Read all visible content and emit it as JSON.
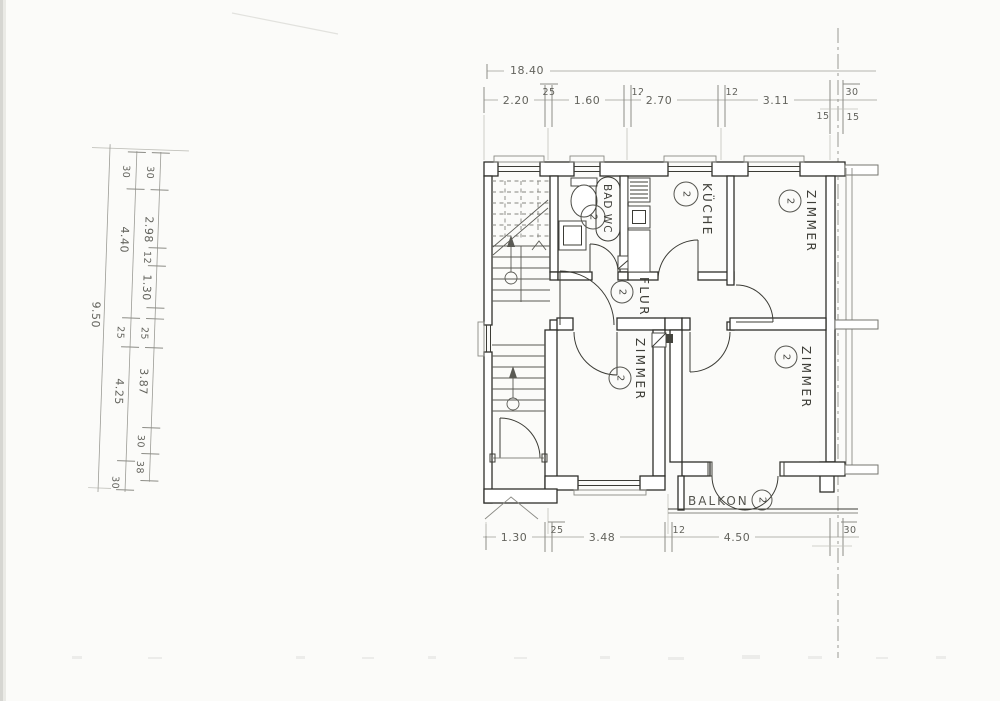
{
  "palette": {
    "paper": "#fbfbf9",
    "wall_ink": "#2f2f2b",
    "dimension_ink": "#63635d",
    "light_line": "#8f8f89"
  },
  "plan": {
    "rooms": {
      "kueche": {
        "label": "KÜCHE",
        "marker": "2"
      },
      "zimmer_top_right": {
        "label": "ZIMMER",
        "marker": "2"
      },
      "zimmer_bottom_middle": {
        "label": "ZIMMER",
        "marker": "2"
      },
      "zimmer_bottom_right": {
        "label": "ZIMMER",
        "marker": "2"
      },
      "bad_wc": {
        "label": "BAD WC",
        "marker": "2"
      },
      "flur": {
        "label": "FLUR",
        "marker": "2"
      },
      "balkon": {
        "label": "BALKON",
        "marker": "2"
      }
    }
  },
  "dimensions": {
    "top": {
      "overall": "18.40",
      "segments": [
        "2.20",
        "25",
        "1.60",
        "12",
        "2.70",
        "12",
        "3.11",
        "30"
      ],
      "sub_left": "15",
      "sub_right": "15"
    },
    "left": {
      "overall": "9.50",
      "outer_chain": [
        "30",
        "4.40",
        "25",
        "4.25",
        "30"
      ],
      "inner_chain": [
        "30",
        "2.98",
        "12",
        "1.30",
        "25",
        "3.87",
        "30",
        "38"
      ]
    },
    "bottom": {
      "segments": [
        "1.30",
        "25",
        "3.48",
        "12",
        "4.50",
        "30"
      ]
    }
  }
}
